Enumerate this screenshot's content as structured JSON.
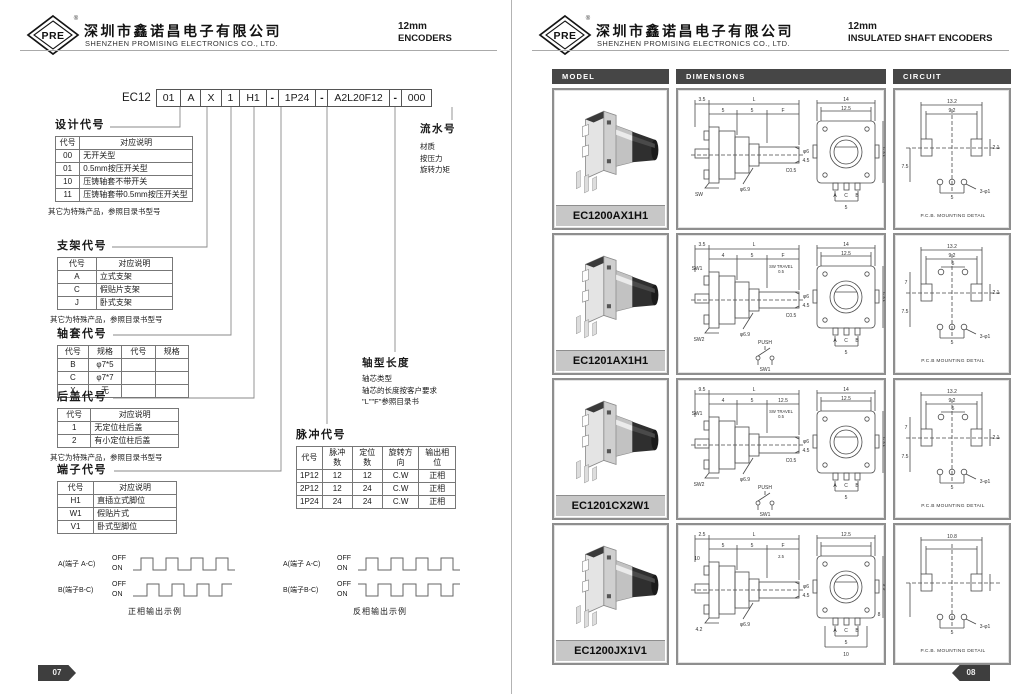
{
  "pages": {
    "left": {
      "header": {
        "logo": "PRE",
        "reg": "®",
        "company_cn": "深圳市鑫诺昌电子有限公司",
        "company_en": "SHENZHEN PROMISING ELECTRONICS CO., LTD.",
        "size": "12mm",
        "type": "ENCODERS"
      },
      "part_number": {
        "prefix": "EC12",
        "cells": [
          "01",
          "A",
          "X",
          "1",
          "H1",
          "-",
          "1P24",
          "-",
          "A2L20F12",
          "-",
          "000"
        ]
      },
      "sections": [
        {
          "title": "设计代号",
          "headers": [
            "代号",
            "对应说明"
          ],
          "rows": [
            [
              "00",
              "无开关型"
            ],
            [
              "01",
              "0.5mm按压开关型"
            ],
            [
              "10",
              "压铸轴套不带开关"
            ],
            [
              "11",
              "压铸轴套带0.5mm按压开关型"
            ]
          ],
          "note": "其它为特殊产品，参照目录书型号"
        },
        {
          "title": "支架代号",
          "headers": [
            "代号",
            "对应说明"
          ],
          "rows": [
            [
              "A",
              "立式支架"
            ],
            [
              "C",
              "假贴片支架"
            ],
            [
              "J",
              "卧式支架"
            ]
          ],
          "note": "其它为特殊产品，参照目录书型号"
        },
        {
          "title": "轴套代号",
          "headers": [
            "代号",
            "规格",
            "代号",
            "规格"
          ],
          "rows": [
            [
              "B",
              "φ7*5",
              "",
              ""
            ],
            [
              "C",
              "φ7*7",
              "",
              ""
            ],
            [
              "X",
              "无",
              "",
              ""
            ]
          ],
          "note": ""
        },
        {
          "title": "后盖代号",
          "headers": [
            "代号",
            "对应说明"
          ],
          "rows": [
            [
              "1",
              "无定位柱后盖"
            ],
            [
              "2",
              "有小定位柱后盖"
            ]
          ],
          "note": "其它为特殊产品，参照目录书型号"
        },
        {
          "title": "端子代号",
          "headers": [
            "代号",
            "对应说明"
          ],
          "rows": [
            [
              "H1",
              "直插立式脚位"
            ],
            [
              "W1",
              "假贴片式"
            ],
            [
              "V1",
              "卧式型脚位"
            ]
          ],
          "note": ""
        },
        {
          "title": "脉冲代号",
          "headers": [
            "代号",
            "脉冲数",
            "定位数",
            "旋转方向",
            "输出相位"
          ],
          "rows": [
            [
              "1P12",
              "12",
              "12",
              "C.W",
              "正相"
            ],
            [
              "2P12",
              "12",
              "24",
              "C.W",
              "正相"
            ],
            [
              "1P24",
              "24",
              "24",
              "C.W",
              "正相"
            ]
          ],
          "note": ""
        }
      ],
      "callouts": {
        "serial": {
          "title": "流水号",
          "lines": [
            "材质",
            "按压力",
            "旋转力矩"
          ]
        },
        "shaft": {
          "title": "轴型长度",
          "lines": [
            "轴芯类型",
            "轴芯的长度按客户要求",
            "\"L\"\"F\"参照目录书"
          ]
        }
      },
      "waveforms": [
        {
          "a_label": "A(端子 A-C)",
          "b_label": "B(端子B-C)",
          "off": "OFF",
          "on": "ON",
          "caption": "正相输出示例"
        },
        {
          "a_label": "A(端子 A-C)",
          "b_label": "B(端子B-C)",
          "off": "OFF",
          "on": "ON",
          "caption": "反相输出示例"
        }
      ],
      "page_number": "07"
    },
    "right": {
      "header": {
        "logo": "PRE",
        "reg": "®",
        "company_cn": "深圳市鑫诺昌电子有限公司",
        "company_en": "SHENZHEN PROMISING ELECTRONICS CO., LTD.",
        "size": "12mm",
        "type": "INSULATED SHAFT ENCODERS"
      },
      "columns": [
        "MODEL",
        "DIMENSIONS",
        "CIRCUIT"
      ],
      "rows": [
        {
          "model": "EC1200AX1H1",
          "opts": [],
          "side": [
            "3.5",
            "L",
            "5",
            "5",
            "F",
            "φ6",
            "4.5",
            "C0.5",
            "φ6.9",
            "",
            "SW",
            "",
            "",
            "",
            ""
          ],
          "front": [
            "14",
            "12.5",
            "13.2",
            "A",
            "C",
            "B",
            "5",
            "",
            ""
          ],
          "circuit": [
            "13.2",
            "9.2",
            "",
            "",
            "7.5",
            "2.1",
            "5",
            "3-φ1"
          ],
          "circuit_caption": "P.C.B. MOUNTING DETAIL"
        },
        {
          "model": "EC1201AX1H1",
          "opts": [
            "switch"
          ],
          "side": [
            "3.5",
            "L",
            "4",
            "5",
            "F",
            "φ6",
            "4.5",
            "C0.5",
            "φ6.9",
            "SW1",
            "SW2",
            "SW TRAVEL",
            "0.5",
            "PUSH",
            "SW1"
          ],
          "front": [
            "14",
            "12.5",
            "13.2",
            "A",
            "C",
            "B",
            "5",
            "",
            ""
          ],
          "circuit": [
            "13.2",
            "9.2",
            "5",
            "7",
            "7.5",
            "2.1",
            "5",
            "3-φ1"
          ],
          "circuit_caption": "P.C.B MOUNTING DETAIL"
        },
        {
          "model": "EC1201CX2W1",
          "opts": [
            "switch"
          ],
          "side": [
            "9.5",
            "L",
            "4",
            "5",
            "12.5",
            "φ6",
            "4.5",
            "C0.5",
            "φ6.9",
            "SW1",
            "SW2",
            "SW TRAVEL",
            "0.5",
            "PUSH",
            "SW1"
          ],
          "front": [
            "14",
            "12.5",
            "13.2",
            "A",
            "C",
            "B",
            "5",
            "",
            ""
          ],
          "circuit": [
            "13.2",
            "9.2",
            "5",
            "7",
            "7.5",
            "2.1",
            "5",
            "3-φ1"
          ],
          "circuit_caption": "P.C.B MOUNTING DETAIL"
        },
        {
          "model": "EC1200JX1V1",
          "opts": [
            "bottom2"
          ],
          "side": [
            "2.5",
            "L",
            "5",
            "5",
            "F",
            "φ6",
            "4.5",
            "",
            "φ6.9",
            "10",
            "4.2",
            "2.5",
            "",
            "",
            ""
          ],
          "front": [
            "12.5",
            "",
            "6.6",
            "A",
            "C",
            "B",
            "5",
            "10",
            "8"
          ],
          "circuit": [
            "10.8",
            "",
            "",
            "",
            "",
            "",
            "5",
            "3-φ1"
          ],
          "circuit_caption": "P.C.B. MOUNTING DETAIL"
        }
      ],
      "page_number": "08"
    }
  }
}
